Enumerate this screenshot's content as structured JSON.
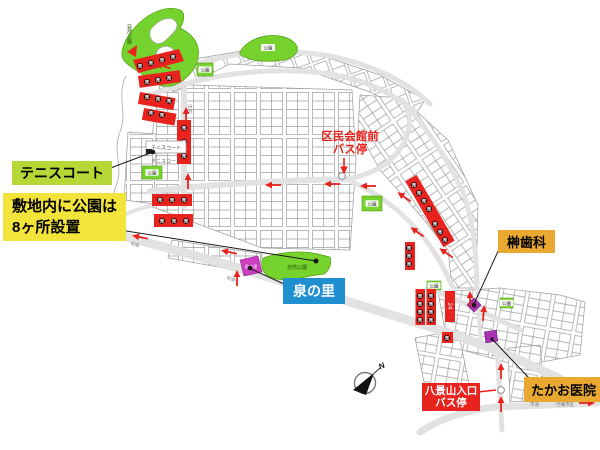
{
  "palette": {
    "accent_red": "#e8231e",
    "park_green": "#76d22c",
    "label_yellow_green": "#b5d837",
    "label_yellow": "#f2e43a",
    "label_blue": "#1f8fd0",
    "label_orange": "#e9a930",
    "facility_purple": "#a832b0",
    "izumi_pink": "#cb3fc0",
    "sale_dot": "#2d0a0a",
    "road_gray": "#e2e2e2",
    "parcel_gray": "#9e9e9e"
  },
  "callouts": {
    "tennis": {
      "label": "テニスコート"
    },
    "parks_note": {
      "line1": "敷地内に公園は",
      "line2": "8ヶ所設置"
    },
    "izumi": {
      "label": "泉の里"
    },
    "kumin_hall_bus": {
      "line1": "区民会館前",
      "line2": "バス停"
    },
    "sakaki_dental": {
      "label": "榊歯科"
    },
    "hakkeizan_bus": {
      "line1": "八景山入口",
      "line2": "バス停"
    },
    "takao_clinic": {
      "label": "たかお医院"
    }
  },
  "map": {
    "nature_park_label": "自然公園",
    "park_label": "公園",
    "tennis_court_map_label": "テニスコート",
    "izumi_map_label": "泉の里",
    "sale_char": "売",
    "lot_number": "24",
    "road_label": "市道",
    "destination_label": "行幡市区",
    "compass_label": "N",
    "small_parks": [
      [
        197,
        63,
        16,
        13
      ],
      [
        142,
        166,
        20,
        13
      ],
      [
        362,
        196,
        20,
        15
      ],
      [
        427,
        281,
        14,
        9
      ],
      [
        500,
        298,
        13,
        10
      ]
    ],
    "route_arrows": [
      [
        268,
        185,
        180
      ],
      [
        327,
        184,
        180
      ],
      [
        363,
        186,
        180
      ],
      [
        158,
        64,
        200
      ],
      [
        188,
        176,
        -90
      ],
      [
        186,
        110,
        -90
      ],
      [
        135,
        236,
        192
      ],
      [
        224,
        251,
        192
      ],
      [
        237,
        273,
        -90
      ],
      [
        400,
        194,
        215
      ],
      [
        413,
        229,
        215
      ],
      [
        442,
        250,
        215
      ],
      [
        470,
        294,
        -90
      ],
      [
        484,
        308,
        -85
      ],
      [
        501,
        366,
        -90
      ],
      [
        501,
        399,
        -90
      ],
      [
        592,
        403,
        0
      ]
    ],
    "sale_markers": [
      [
        140,
        66
      ],
      [
        151,
        63
      ],
      [
        162,
        60
      ],
      [
        173,
        57
      ],
      [
        147,
        82
      ],
      [
        158,
        80
      ],
      [
        169,
        78
      ],
      [
        147,
        97
      ],
      [
        158,
        99
      ],
      [
        169,
        101
      ],
      [
        151,
        113
      ],
      [
        162,
        115
      ],
      [
        184,
        128
      ],
      [
        184,
        142
      ],
      [
        184,
        156
      ],
      [
        160,
        200
      ],
      [
        172,
        200
      ],
      [
        184,
        200
      ],
      [
        162,
        221
      ],
      [
        174,
        221
      ],
      [
        186,
        221
      ],
      [
        414,
        185
      ],
      [
        419,
        193
      ],
      [
        424,
        201
      ],
      [
        429,
        209
      ],
      [
        435,
        224
      ],
      [
        440,
        232
      ],
      [
        445,
        240
      ],
      [
        420,
        296
      ],
      [
        420,
        304
      ],
      [
        420,
        312
      ],
      [
        420,
        320
      ],
      [
        431,
        296
      ],
      [
        431,
        304
      ],
      [
        431,
        312
      ],
      [
        431,
        320
      ],
      [
        409,
        248
      ],
      [
        409,
        256
      ],
      [
        409,
        264
      ],
      [
        447,
        338
      ]
    ]
  }
}
